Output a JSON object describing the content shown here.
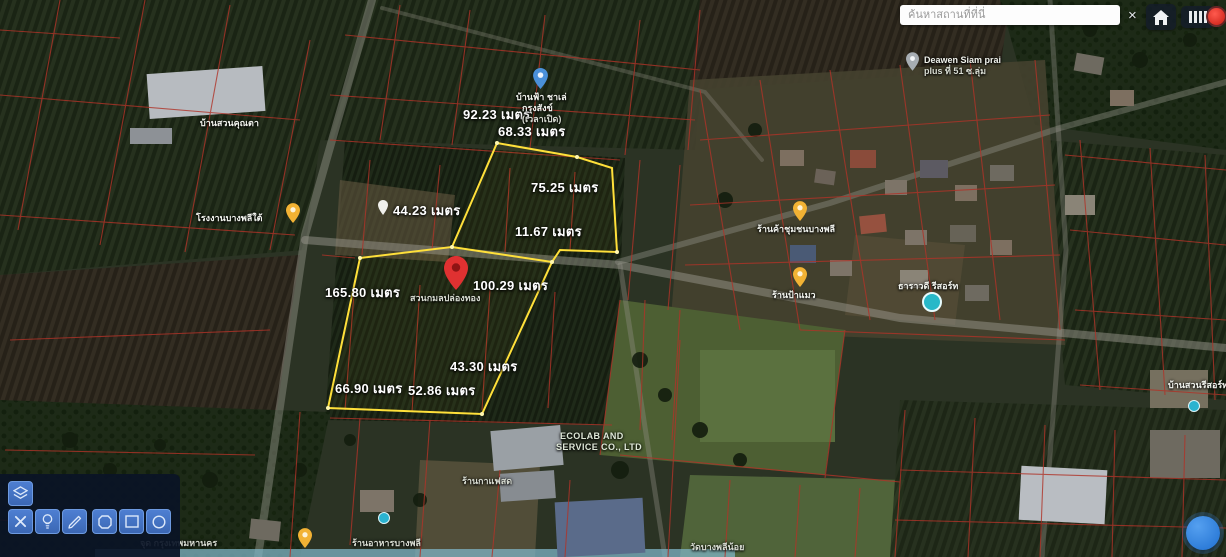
{
  "search": {
    "placeholder": "ค้นหาสถานที่ที่นี่",
    "clear_label": "×"
  },
  "measurements": [
    {
      "text": "92.23 เมตร"
    },
    {
      "text": "68.33 เมตร"
    },
    {
      "text": "75.25 เมตร"
    },
    {
      "text": "44.23 เมตร"
    },
    {
      "text": "11.67 เมตร"
    },
    {
      "text": "100.29 เมตร"
    },
    {
      "text": "165.80 เมตร"
    },
    {
      "text": "43.30 เมตร"
    },
    {
      "text": "66.90 เมตร"
    },
    {
      "text": "52.86 เมตร"
    }
  ],
  "pois": {
    "red_pin_label": "สวนกมลปล่องทอง",
    "blue_pin_line1": "บ้านฟ้า ชาเล่",
    "blue_pin_line2": "กรุงสังข์",
    "blue_pin_line3": "(เวลาเปิด)",
    "deawen_line1": "Deawen Siam prai",
    "deawen_line2": "plus ที่ 51 ซ.ลุ่ม",
    "factory_left": "โรงงานบางพลีใต้",
    "shop_right": "ร้านค้าชุมชนบางพลี",
    "shop_mid": "ร้านป้าแมว",
    "resort_teal": "ธาราวดี รีสอร์ท",
    "ecolab_line1": "ECOLAB AND",
    "ecolab_line2": "SERVICE CO., LTD",
    "top_left": "บ้านสวนคุณตา",
    "bottom_right": "บ้านสวนรีสอร์ท",
    "coffee": "ร้านกาแฟสด",
    "bottom_1": "จุด กรุงเทพมหานคร",
    "bottom_2": "ร้านอาหารบางพลี",
    "bottom_3": "วัดบางพลีน้อย"
  },
  "toolbar": {
    "layers": "layers",
    "clear": "clear",
    "idea": "idea",
    "draw": "draw",
    "polygon": "polygon",
    "rectangle": "rectangle",
    "circle": "circle"
  },
  "colors": {
    "measure_polygon": "#ffe03a",
    "parcel_lines": "#b03328",
    "tool_button": "#3b67b4",
    "fab": "#1f6fd0",
    "pin_red": "#e03131"
  }
}
